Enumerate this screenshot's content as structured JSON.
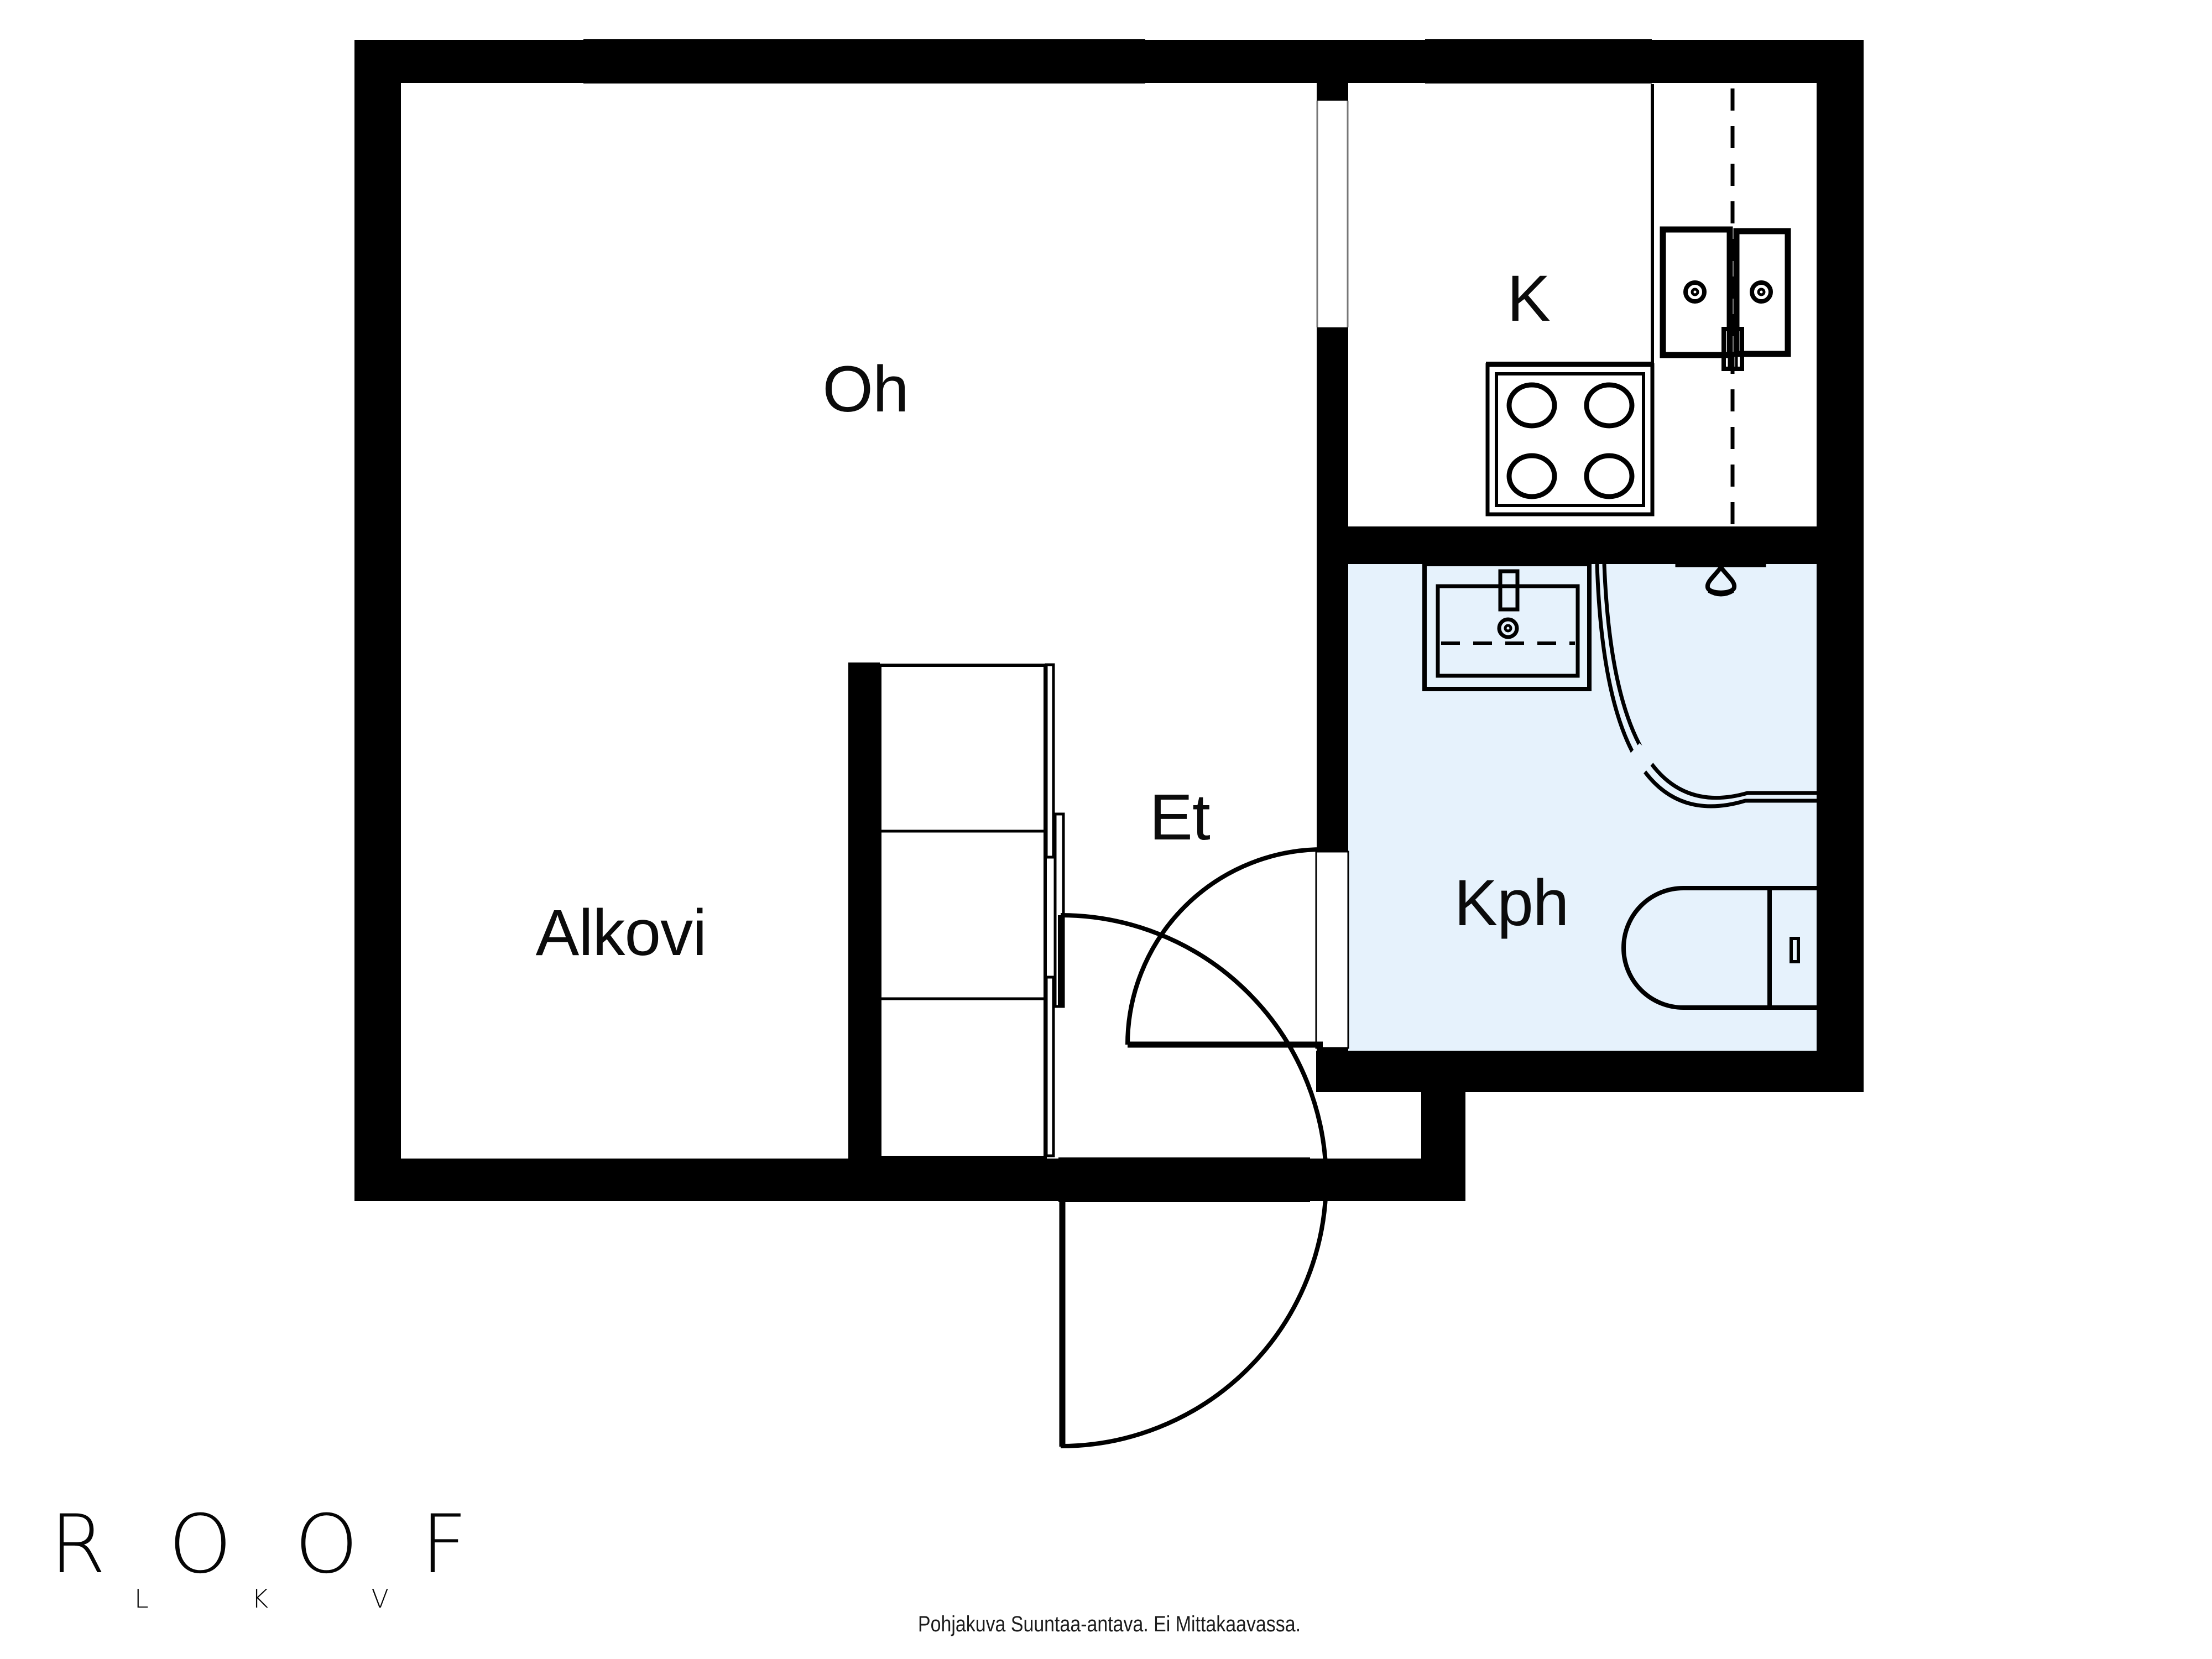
{
  "document": {
    "background_color": "#ffffff"
  },
  "floor_plan": {
    "wall_color": "#000000",
    "bathroom_floor_color": "#e6f2fc",
    "rooms": {
      "living_room": {
        "label": "Oh"
      },
      "kitchen": {
        "label": "K"
      },
      "alcove": {
        "label": "Alkovi"
      },
      "entry_hall": {
        "label": "Et"
      },
      "bathroom": {
        "label": "Kph"
      }
    },
    "fixtures": {
      "kitchen": [
        "stove-icon",
        "double-sink-icon",
        "counter-line",
        "vent-duct-dashed-line"
      ],
      "bathroom": [
        "washbasin-icon",
        "shower-icon",
        "shower-curtain-arc",
        "toilet-icon"
      ],
      "entry_hall": [
        "closet-sliding-doors",
        "entrance-door-arc",
        "bathroom-door-arc"
      ]
    },
    "window_count": 3
  },
  "branding": {
    "logo_text": "ROOF",
    "logo_subtext": "L K V"
  },
  "footer": {
    "disclaimer": "Pohjakuva Suuntaa-antava. Ei Mittakaavassa."
  }
}
